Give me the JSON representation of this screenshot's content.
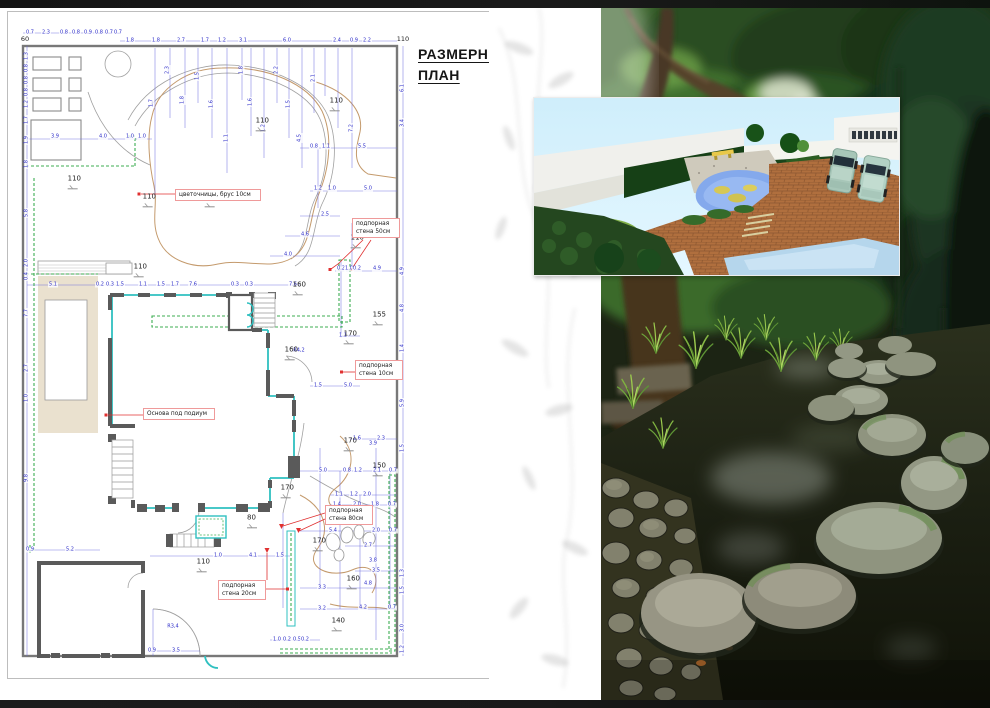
{
  "page": {
    "top_bar_color": "#141414",
    "bottom_bar_color": "#191919"
  },
  "plan": {
    "title": {
      "line1": "РАЗМЕРНЫЙ",
      "line2": "ПЛАН"
    },
    "corner_dims": [
      [
        "60",
        25,
        31
      ],
      [
        "110",
        403,
        31
      ]
    ],
    "annotations": [
      {
        "text": "цветочницы, брус 10см",
        "x": 175,
        "y": 181,
        "w": 78
      },
      {
        "text": "подпорная\nстена 50см",
        "x": 352,
        "y": 210,
        "w": 40
      },
      {
        "text": "подпорная\nстена 10см",
        "x": 355,
        "y": 352,
        "w": 40
      },
      {
        "text": "Основа под подиум",
        "x": 143,
        "y": 400,
        "w": 64
      },
      {
        "text": "подпорная\nстена 80см",
        "x": 325,
        "y": 497,
        "w": 40
      },
      {
        "text": "подпорная\nстена 20см",
        "x": 218,
        "y": 572,
        "w": 40
      }
    ],
    "elevations": [
      [
        "110",
        335,
        103
      ],
      [
        "110",
        261,
        123
      ],
      [
        "110",
        73,
        181
      ],
      [
        "110",
        148,
        199
      ],
      [
        "115",
        210,
        199
      ],
      [
        "110",
        356,
        240
      ],
      [
        "110",
        139,
        269
      ],
      [
        "160",
        298,
        287
      ],
      [
        "155",
        378,
        317
      ],
      [
        "170",
        349,
        336
      ],
      [
        "160",
        290,
        352
      ],
      [
        "170",
        349,
        443
      ],
      [
        "150",
        378,
        468
      ],
      [
        "170",
        286,
        490
      ],
      [
        "80",
        251,
        520
      ],
      [
        "170",
        318,
        543
      ],
      [
        "110",
        202,
        564
      ],
      [
        "160",
        352,
        581
      ],
      [
        "140",
        337,
        623
      ]
    ],
    "dims": [
      [
        "0.7",
        30,
        25,
        0
      ],
      [
        "2.3",
        46,
        25,
        0
      ],
      [
        "0.8",
        64,
        25,
        0
      ],
      [
        "0.8",
        76,
        25,
        0
      ],
      [
        "0.9",
        88,
        25,
        0
      ],
      [
        "0.8",
        99,
        25,
        0
      ],
      [
        "0.7",
        109,
        25,
        0
      ],
      [
        "0.7",
        118,
        25,
        0
      ],
      [
        "1.8",
        130,
        33,
        0
      ],
      [
        "1.8",
        156,
        33,
        0
      ],
      [
        "2.7",
        181,
        33,
        0
      ],
      [
        "1.7",
        205,
        33,
        0
      ],
      [
        "1.2",
        222,
        33,
        0
      ],
      [
        "3.1",
        243,
        33,
        0
      ],
      [
        "6.0",
        287,
        33,
        0
      ],
      [
        "2.4",
        337,
        33,
        0
      ],
      [
        "0.9",
        354,
        33,
        0
      ],
      [
        "2.2",
        367,
        33,
        0
      ],
      [
        "1.3",
        27,
        48,
        1
      ],
      [
        "0.8",
        27,
        60,
        1
      ],
      [
        "0.8",
        27,
        72,
        1
      ],
      [
        "0.8",
        27,
        84,
        1
      ],
      [
        "1.2",
        27,
        96,
        1
      ],
      [
        "1.7",
        27,
        112,
        1
      ],
      [
        "1.9",
        27,
        132,
        1
      ],
      [
        "1.8",
        27,
        156,
        1
      ],
      [
        "5.8",
        27,
        205,
        1
      ],
      [
        "2.0",
        27,
        255,
        1
      ],
      [
        "0.4",
        27,
        268,
        1
      ],
      [
        "7.7",
        27,
        305,
        1
      ],
      [
        "2.7",
        27,
        360,
        1
      ],
      [
        "1.0",
        27,
        390,
        1
      ],
      [
        "9.8",
        27,
        470,
        1
      ],
      [
        "3.9",
        55,
        129,
        0
      ],
      [
        "4.0",
        103,
        129,
        0
      ],
      [
        "1.0",
        130,
        129,
        0
      ],
      [
        "1.0",
        142,
        129,
        0
      ],
      [
        "1.7",
        152,
        95,
        1
      ],
      [
        "2.3",
        168,
        62,
        1
      ],
      [
        "1.8",
        183,
        92,
        1
      ],
      [
        "1.5",
        198,
        68,
        1
      ],
      [
        "1.6",
        212,
        96,
        1
      ],
      [
        "1.1",
        227,
        130,
        1
      ],
      [
        "1.8",
        242,
        62,
        1
      ],
      [
        "1.6",
        251,
        94,
        1
      ],
      [
        "1.2",
        264,
        120,
        1
      ],
      [
        "2.2",
        277,
        62,
        1
      ],
      [
        "1.5",
        289,
        96,
        1
      ],
      [
        "2.1",
        314,
        70,
        1
      ],
      [
        "4.5",
        300,
        130,
        1
      ],
      [
        "7.2",
        352,
        120,
        1
      ],
      [
        "0.8",
        314,
        139,
        0
      ],
      [
        "1.1",
        326,
        139,
        0
      ],
      [
        "5.5",
        362,
        139,
        0
      ],
      [
        "1.2",
        318,
        181,
        0
      ],
      [
        "1.0",
        332,
        181,
        0
      ],
      [
        "5.0",
        368,
        181,
        0
      ],
      [
        "2.5",
        325,
        207,
        0
      ],
      [
        "4.6",
        305,
        227,
        0
      ],
      [
        "4.0",
        288,
        247,
        0
      ],
      [
        "0.2",
        341,
        261,
        0
      ],
      [
        "1.0",
        349,
        261,
        0
      ],
      [
        "0.2",
        357,
        261,
        0
      ],
      [
        "4.9",
        377,
        261,
        0
      ],
      [
        "5.1",
        53,
        277,
        0
      ],
      [
        "0.2",
        100,
        277,
        0
      ],
      [
        "0.3",
        110,
        277,
        0
      ],
      [
        "1.5",
        120,
        277,
        0
      ],
      [
        "1.1",
        143,
        277,
        0
      ],
      [
        "1.5",
        161,
        277,
        0
      ],
      [
        "1.7",
        175,
        277,
        0
      ],
      [
        "7.6",
        193,
        277,
        0
      ],
      [
        "0.3",
        235,
        277,
        0
      ],
      [
        "0.3",
        249,
        277,
        0
      ],
      [
        "7.6",
        293,
        277,
        0
      ],
      [
        "6.1",
        403,
        80,
        1
      ],
      [
        "3.4",
        403,
        115,
        1
      ],
      [
        "4.9",
        403,
        263,
        1
      ],
      [
        "4.8",
        403,
        300,
        1
      ],
      [
        "1.4",
        403,
        340,
        1
      ],
      [
        "5.9",
        403,
        395,
        1
      ],
      [
        "1.5",
        403,
        440,
        1
      ],
      [
        "1.3",
        403,
        565,
        1
      ],
      [
        "1.5",
        403,
        582,
        1
      ],
      [
        "3.0",
        403,
        620,
        1
      ],
      [
        "1.2",
        403,
        641,
        1
      ],
      [
        "1.1",
        343,
        328,
        0
      ],
      [
        "1.5",
        318,
        378,
        0
      ],
      [
        "5.0",
        348,
        378,
        0
      ],
      [
        "1.6",
        357,
        431,
        0
      ],
      [
        "2.3",
        381,
        431,
        0
      ],
      [
        "3.9",
        373,
        436,
        0
      ],
      [
        "5.0",
        323,
        463,
        0
      ],
      [
        "0.8",
        347,
        463,
        0
      ],
      [
        "1.2",
        358,
        463,
        0
      ],
      [
        "2.1",
        377,
        463,
        0
      ],
      [
        "0.7",
        393,
        463,
        0
      ],
      [
        "1.1",
        339,
        487,
        0
      ],
      [
        "1.2",
        354,
        487,
        0
      ],
      [
        "2.0",
        367,
        487,
        0
      ],
      [
        "1.4",
        337,
        497,
        0
      ],
      [
        "2.0",
        357,
        497,
        0
      ],
      [
        "1.8",
        375,
        497,
        0
      ],
      [
        "0.7",
        392,
        497,
        0
      ],
      [
        "5.4",
        333,
        523,
        0
      ],
      [
        "2.0",
        376,
        523,
        0
      ],
      [
        "0.7",
        393,
        523,
        0
      ],
      [
        "2.7",
        368,
        538,
        0
      ],
      [
        "3.8",
        373,
        553,
        0
      ],
      [
        "3.5",
        376,
        563,
        0
      ],
      [
        "4.8",
        368,
        576,
        0
      ],
      [
        "3.3",
        322,
        580,
        0
      ],
      [
        "3.2",
        322,
        601,
        0
      ],
      [
        "4.2",
        363,
        600,
        0
      ],
      [
        "0.7",
        392,
        600,
        0
      ],
      [
        "1.0",
        277,
        632,
        0
      ],
      [
        "0.2",
        287,
        632,
        0
      ],
      [
        "0.5",
        297,
        632,
        0
      ],
      [
        "0.2",
        305,
        632,
        0
      ],
      [
        "1.0",
        218,
        548,
        0
      ],
      [
        "4.1",
        253,
        548,
        0
      ],
      [
        "1.5",
        280,
        548,
        0
      ],
      [
        "0.9",
        30,
        542,
        0
      ],
      [
        "5.2",
        70,
        542,
        0
      ],
      [
        "0.9",
        152,
        643,
        0
      ],
      [
        "3.5",
        176,
        643,
        0
      ],
      [
        "R4,2",
        299,
        343,
        0
      ],
      [
        "R3,4",
        173,
        619,
        0
      ]
    ],
    "colors": {
      "dimension_blue": "#2b2bc8",
      "wall_gray": "#5a5a5a",
      "glazing_teal": "#2fc0c0",
      "edging_green": "#3cae52",
      "contour_tan": "#c49a6c",
      "annotation_red": "#e03030",
      "podium_beige": "#eae1cf"
    }
  }
}
